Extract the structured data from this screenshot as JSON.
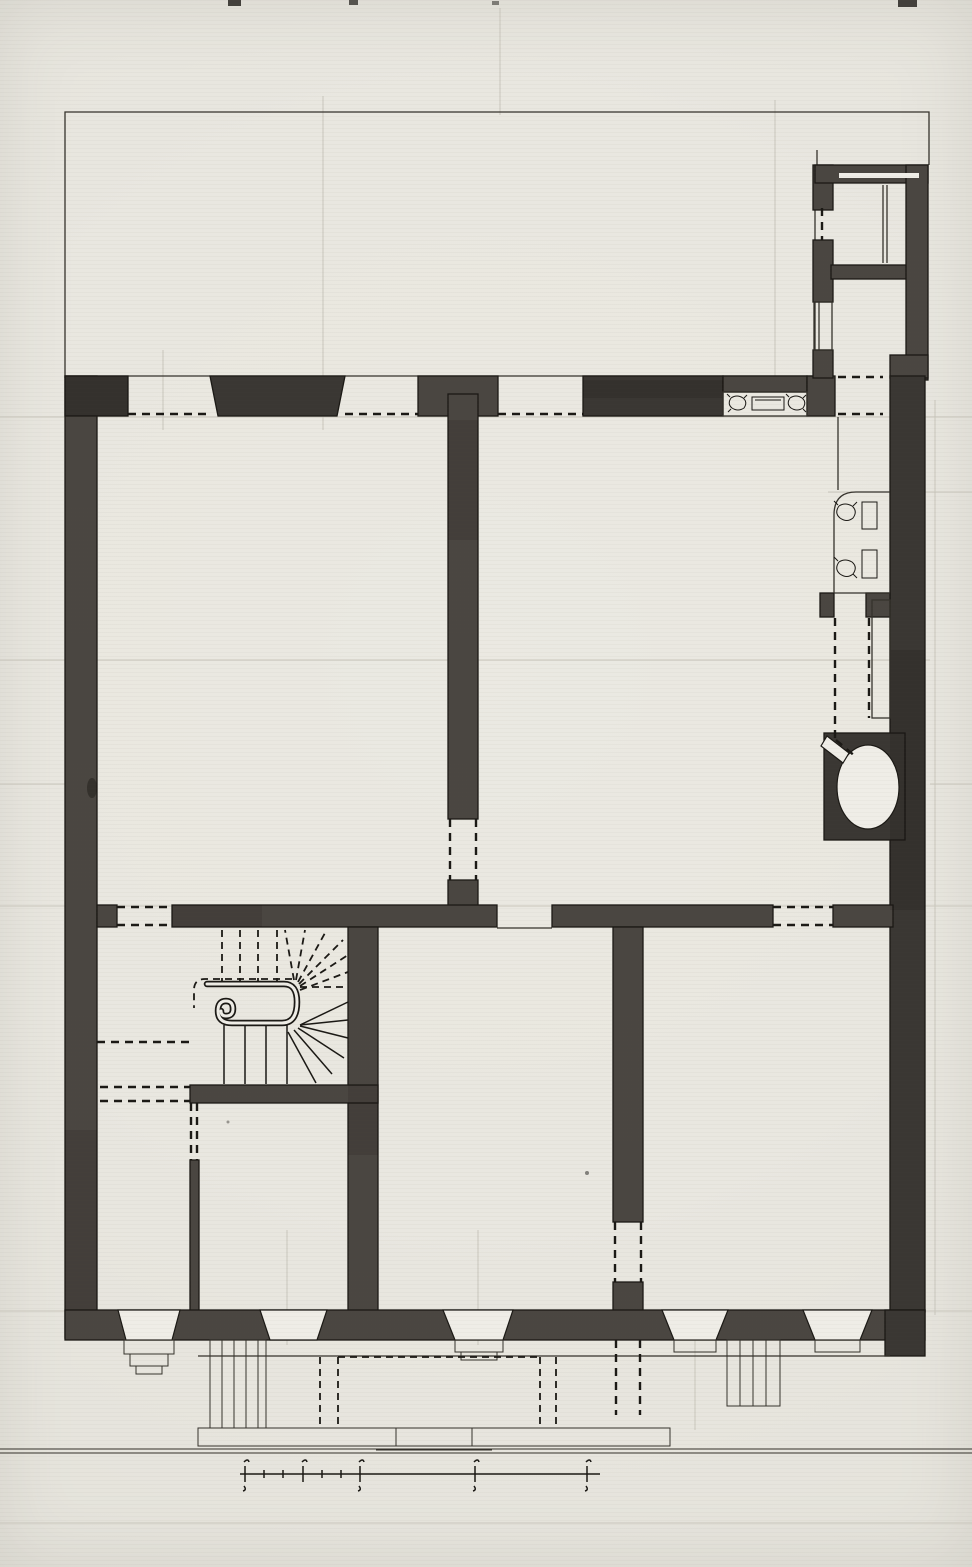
{
  "document": {
    "kind": "floor-plan-drawing",
    "visible_text": ""
  },
  "colors": {
    "paper": "#e9e7e0",
    "paper_bright": "#efede7",
    "ink": "#1b1915",
    "line": "#35322c",
    "faint": "#c9c6bc",
    "wall": "#4a4641",
    "wall_dark": "#3a3733",
    "wall_light": "#585450",
    "shade": "rgba(15,12,8,0.12)"
  },
  "scale_bar": {
    "major_ticks": 5,
    "minor_ticks": 4
  },
  "stair": {
    "upper_flight_steps": 4,
    "winder_steps": 7,
    "lower_flight_steps": 4
  },
  "fixtures": {
    "privy_seats": 1,
    "alcove_chairs": 2,
    "alcove_tables": 2,
    "niche_chairs": 2,
    "niche_tables": 1
  }
}
